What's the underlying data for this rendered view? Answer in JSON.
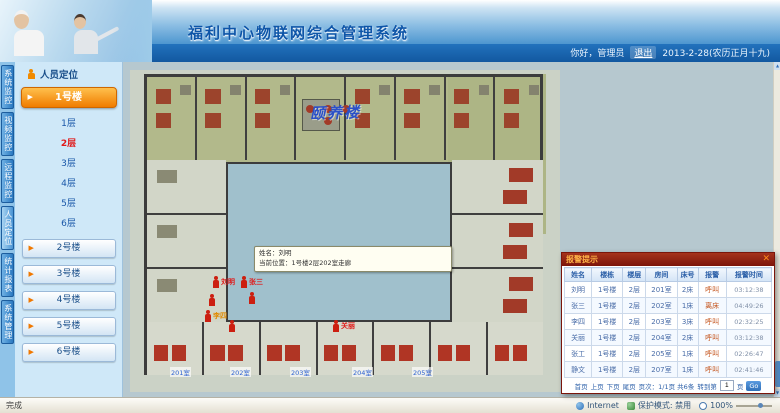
{
  "colors": {
    "header_blue": "#1a6ab8",
    "accent_orange": "#f07c00",
    "alarm_red": "#cc1f10",
    "popup_title_red": "#8e1f10",
    "courtyard_teal": "#a0c0cc"
  },
  "icons": {
    "arrow_right": "▶",
    "arrow_up": "▲",
    "arrow_down": "▼",
    "close": "✕"
  },
  "header": {
    "title": "福利中心物联网综合管理系统",
    "greeting": "你好，管理员",
    "logout": "退出",
    "date": "2013-2-28(农历正月十九)"
  },
  "side_tabs": [
    {
      "label": "系统监控",
      "active": false
    },
    {
      "label": "视频监控",
      "active": false
    },
    {
      "label": "远程监控",
      "active": false
    },
    {
      "label": "人员定位",
      "active": true
    },
    {
      "label": "统计报表",
      "active": false
    },
    {
      "label": "系统管理",
      "active": false
    }
  ],
  "sidebar": {
    "panel_title": "人员定位",
    "active_building": "1号楼",
    "floors": [
      {
        "label": "1层",
        "active": false
      },
      {
        "label": "2层",
        "active": true
      },
      {
        "label": "3层",
        "active": false
      },
      {
        "label": "4层",
        "active": false
      },
      {
        "label": "5层",
        "active": false
      },
      {
        "label": "6层",
        "active": false
      }
    ],
    "buildings": [
      "2号楼",
      "3号楼",
      "4号楼",
      "5号楼",
      "6号楼"
    ]
  },
  "floorplan": {
    "caption": "颐养楼",
    "room_labels": [
      "201室",
      "202室",
      "203室",
      "204室",
      "205室"
    ],
    "tooltip": {
      "line1": "姓名：刘明",
      "line2": "当前位置：1号楼2层202室走廊"
    },
    "persons": [
      {
        "name": "刘明",
        "x": 82,
        "y": 206,
        "label_color": "red"
      },
      {
        "name": "张三",
        "x": 110,
        "y": 206,
        "label_color": "red"
      },
      {
        "name": "",
        "x": 78,
        "y": 224,
        "label_color": "red"
      },
      {
        "name": "",
        "x": 118,
        "y": 222,
        "label_color": "red"
      },
      {
        "name": "李四",
        "x": 74,
        "y": 240,
        "label_color": "orange"
      },
      {
        "name": "",
        "x": 98,
        "y": 250,
        "label_color": "red"
      },
      {
        "name": "关丽",
        "x": 202,
        "y": 250,
        "label_color": "red"
      }
    ]
  },
  "alarm_popup": {
    "title": "报警提示",
    "columns": [
      "姓名",
      "楼栋",
      "楼层",
      "房间",
      "床号",
      "报警",
      "报警时间"
    ],
    "rows": [
      [
        "刘明",
        "1号楼",
        "2层",
        "201室",
        "2床",
        "呼叫",
        "03:12:38"
      ],
      [
        "张三",
        "1号楼",
        "2层",
        "202室",
        "1床",
        "离床",
        "04:49:26"
      ],
      [
        "李四",
        "1号楼",
        "2层",
        "203室",
        "3床",
        "呼叫",
        "02:32:25"
      ],
      [
        "关丽",
        "1号楼",
        "2层",
        "204室",
        "2床",
        "呼叫",
        "03:12:38"
      ],
      [
        "张工",
        "1号楼",
        "2层",
        "205室",
        "1床",
        "呼叫",
        "02:26:47"
      ],
      [
        "静文",
        "1号楼",
        "2层",
        "207室",
        "1床",
        "呼叫",
        "02:41:46"
      ]
    ],
    "pager": {
      "first": "首页",
      "prev": "上页",
      "next": "下页",
      "last": "尾页",
      "info": "页次：1/1页 共6条",
      "goto_label": "转到第",
      "page_value": "1",
      "page_unit": "页",
      "go": "Go"
    }
  },
  "status_bar": {
    "left": "完成",
    "zone": "Internet",
    "protected_mode": "保护模式: 禁用",
    "zoom": "100%"
  }
}
